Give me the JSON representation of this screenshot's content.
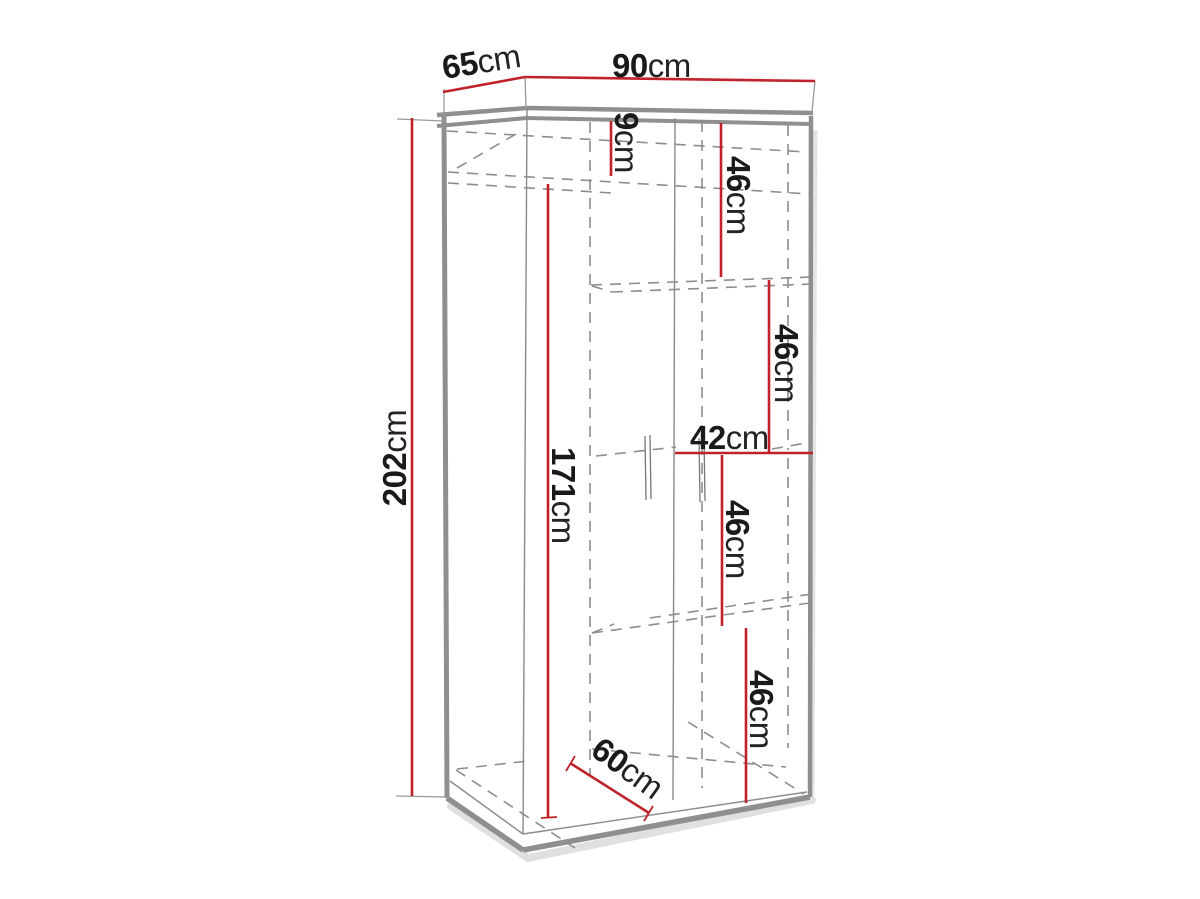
{
  "diagram": {
    "subject": "wardrobe-dimension-drawing",
    "dimensions": {
      "depth": {
        "value": "65",
        "unit": "cm"
      },
      "width": {
        "value": "90",
        "unit": "cm"
      },
      "height": {
        "value": "202",
        "unit": "cm"
      },
      "top_section": {
        "value": "9",
        "unit": "cm"
      },
      "shelf_1": {
        "value": "46",
        "unit": "cm"
      },
      "shelf_2": {
        "value": "46",
        "unit": "cm"
      },
      "right_section_width": {
        "value": "42",
        "unit": "cm"
      },
      "shelf_3": {
        "value": "46",
        "unit": "cm"
      },
      "shelf_4": {
        "value": "46",
        "unit": "cm"
      },
      "hanging_height": {
        "value": "171",
        "unit": "cm"
      },
      "left_section_width": {
        "value": "60",
        "unit": "cm"
      }
    },
    "colors": {
      "dimension_line": "#bf2228",
      "cabinet_outline": "#8f8f8f",
      "hidden_line": "#8d8d8d",
      "label_text": "#1a1a1a",
      "background": "#ffffff"
    }
  }
}
